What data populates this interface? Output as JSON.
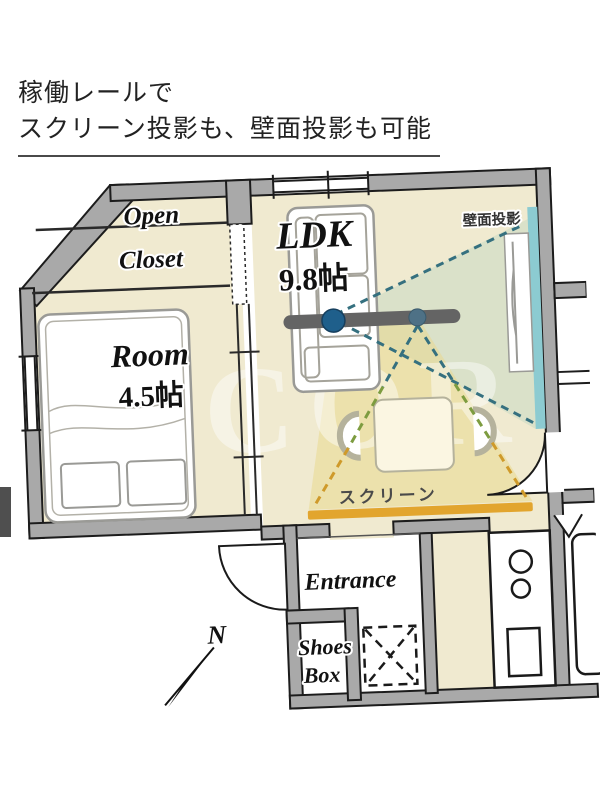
{
  "header": {
    "line1": "稼働レールで",
    "line2": "スクリーン投影も、壁面投影も可能"
  },
  "floorplan": {
    "rooms": {
      "open_closet": {
        "line1": "Open",
        "line2": "Closet"
      },
      "room": {
        "name": "Room",
        "size": "4.5帖"
      },
      "ldk": {
        "name": "LDK",
        "size": "9.8帖"
      },
      "entrance": {
        "label": "Entrance"
      },
      "shoes_box": {
        "line1": "Shoes",
        "line2": "Box"
      }
    },
    "projection": {
      "wall_label": "壁面投影",
      "screen_label": "スクリーン",
      "rail_color": "#646464",
      "node_color": "#1f5f8b",
      "node2_color": "#4e7186",
      "screen_bar_color": "#e2a52e",
      "wall_strip_color": "#8ccbd1",
      "beam_teal": "#35707f",
      "beam_green": "#7d9c40",
      "beam_yellow": "#cf9a2a",
      "cone_color": "#e9d98e"
    },
    "compass": {
      "label": "N"
    },
    "watermark": "M COR",
    "colors": {
      "floor": "#f0ead0",
      "wall": "#a9a9a9"
    }
  }
}
